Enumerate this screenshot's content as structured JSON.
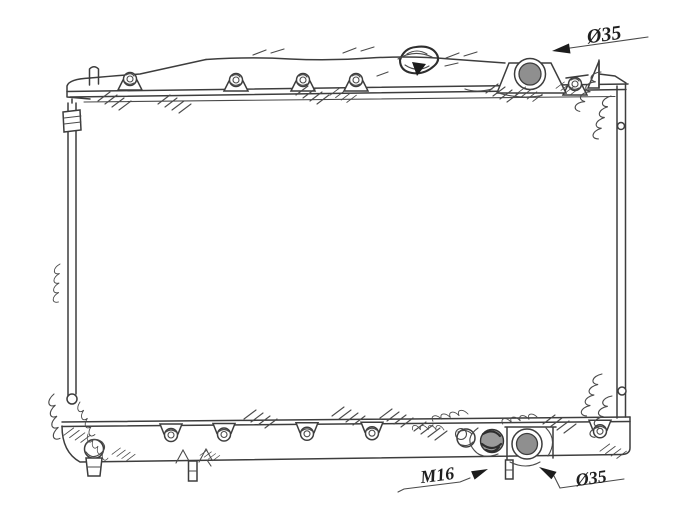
{
  "annotations": {
    "inlet": {
      "label": "Ø35"
    },
    "thread": {
      "label": "M16"
    },
    "outlet": {
      "label": "Ø35"
    }
  },
  "colors": {
    "line": "#3d3d3d",
    "port_fill": "#8f8f8f",
    "fitting_fill": "#9a9a9a",
    "background": "#ffffff"
  }
}
